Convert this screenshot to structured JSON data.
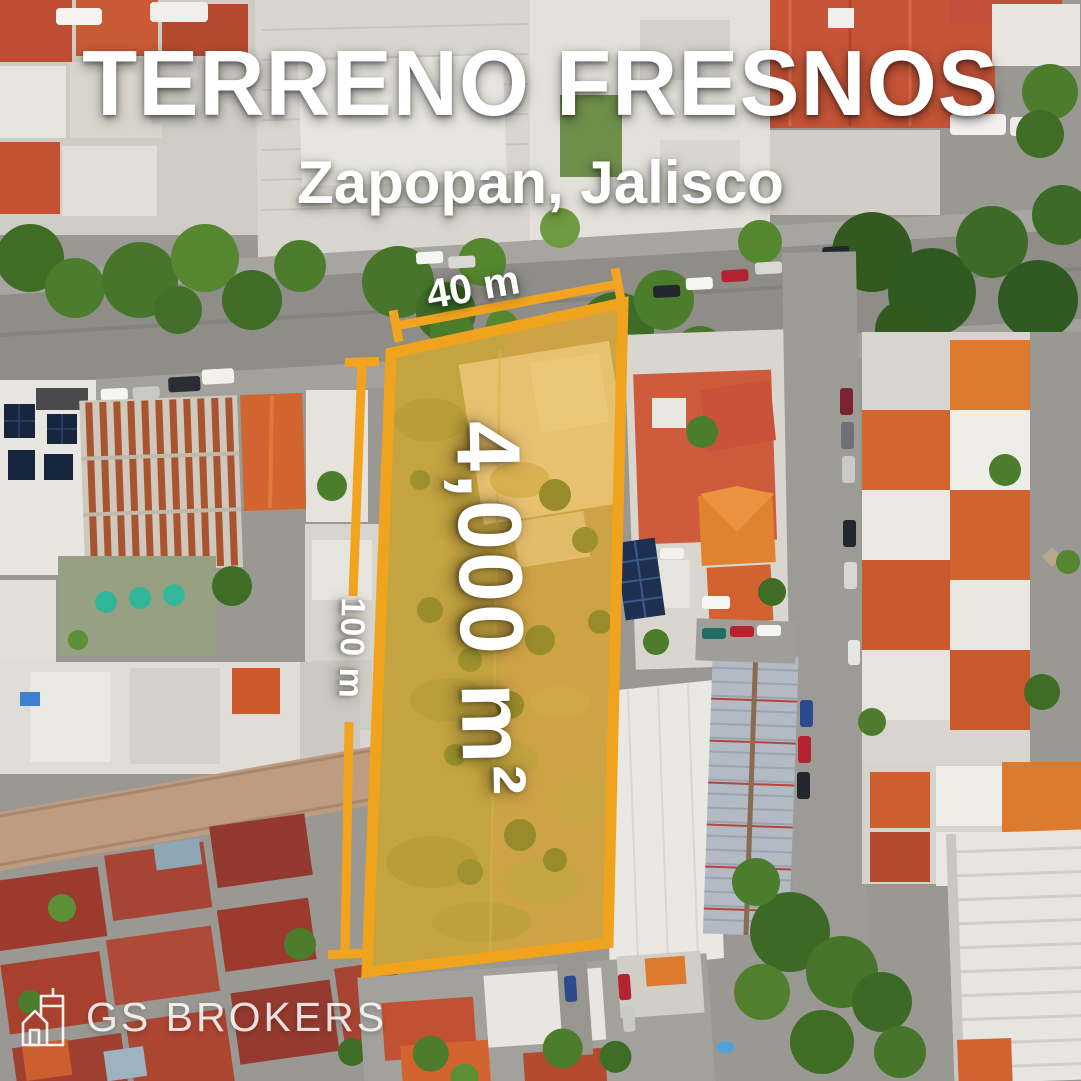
{
  "poster": {
    "title": "TERRENO FRESNOS",
    "subtitle": "Zapopan, Jalisco",
    "parcel": {
      "width_label": "40 m",
      "length_label": "100 m",
      "area_label": "4,000 m²"
    },
    "brand": {
      "name": "GS BROKERS"
    },
    "colors": {
      "accent_orange": "#F2A41E",
      "parcel_fill": "#F2B026",
      "label_text": "#FFFFFF"
    }
  }
}
